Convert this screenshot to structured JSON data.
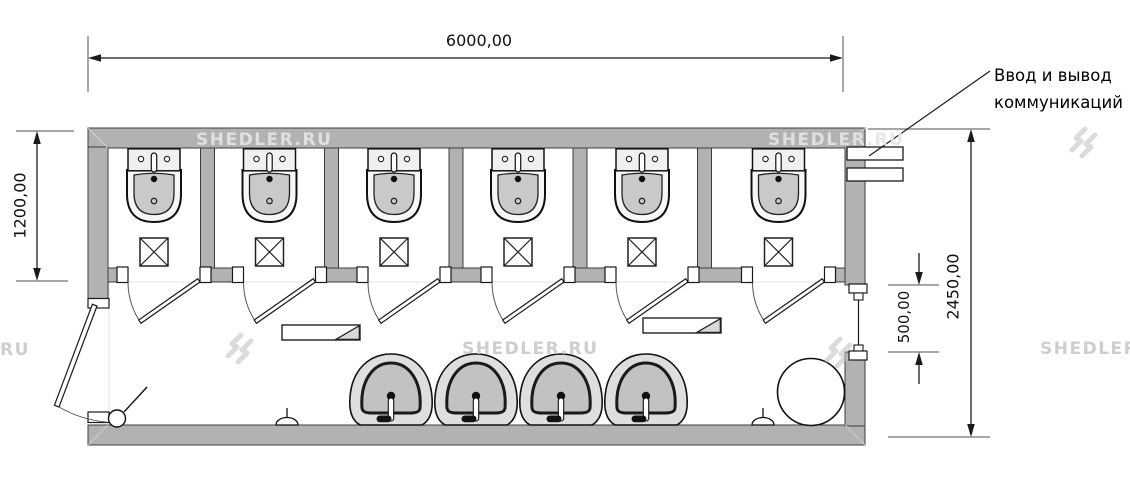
{
  "plan": {
    "dimensions": {
      "top_width": "6000,00",
      "stall_depth": "1200,00",
      "total_depth": "2450,00",
      "window_width": "500,00"
    },
    "annotation": {
      "line1": "Ввод и вывод",
      "line2": "коммуникаций"
    }
  },
  "watermark": {
    "text": "SHEDLER.RU",
    "fragment": "RU"
  },
  "colors": {
    "wall": "#b2b2b2",
    "fixture_fill": "#c9c9c9",
    "outline": "#1a1a1a",
    "dimension_line": "#5a5a5a",
    "extension_line": "#8a8a8a",
    "watermark": "#c8c8c8",
    "background": "#ffffff"
  }
}
